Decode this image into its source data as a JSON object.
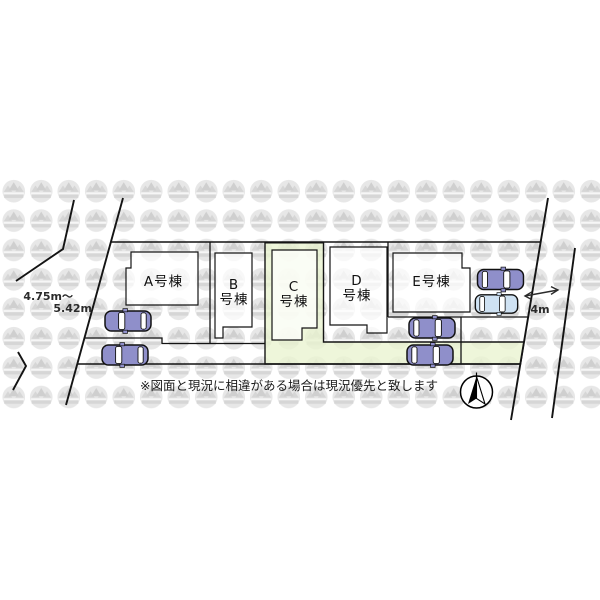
{
  "plan": {
    "buildings": [
      {
        "id": "A",
        "label": "A号棟"
      },
      {
        "id": "B",
        "label_line1": "B",
        "label_line2": "号棟"
      },
      {
        "id": "C",
        "label_line1": "C",
        "label_line2": "号棟",
        "highlighted": true
      },
      {
        "id": "D",
        "label_line1": "D",
        "label_line2": "号棟"
      },
      {
        "id": "E",
        "label": "E号棟"
      }
    ],
    "measurements": {
      "left_road_width_from": "4.75m〜",
      "left_road_width_to": "5.42m",
      "right_road_width": "4m"
    },
    "disclaimer": "※図面と現況に相違がある場合は現況優先と致します",
    "cars": [
      {
        "location": "lot-a-row1",
        "color": "purple",
        "facing": "left"
      },
      {
        "location": "lot-a-row2",
        "color": "purple",
        "facing": "left"
      },
      {
        "location": "lot-d-row1",
        "color": "purple",
        "facing": "right"
      },
      {
        "location": "lot-d-row2",
        "color": "purple",
        "facing": "right"
      },
      {
        "location": "lot-e-row1",
        "color": "purple",
        "facing": "right"
      },
      {
        "location": "lot-e-row2",
        "color": "lightblue",
        "facing": "right"
      }
    ],
    "colors": {
      "highlight_lot": "#e9f4cf",
      "car_purple": "#8f8fca",
      "car_lightblue": "#cfe2f3",
      "line": "#141414",
      "watermark_gray": "#e6e6e6"
    }
  }
}
